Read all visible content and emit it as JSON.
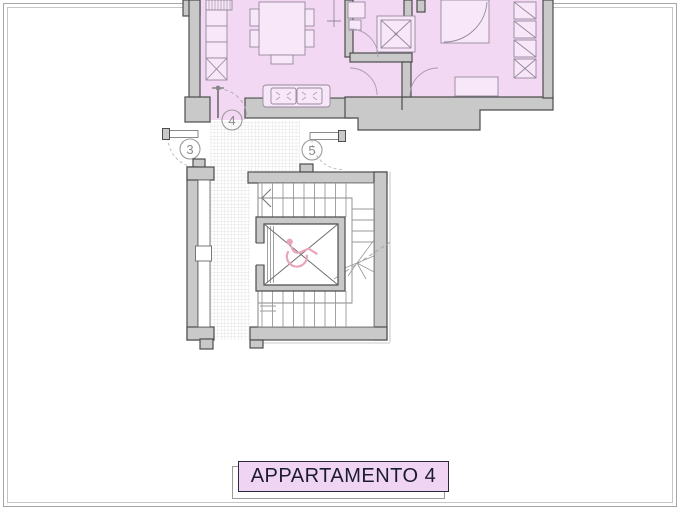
{
  "page": {
    "background": "#ffffff",
    "frame_color": "#a6a6a6"
  },
  "plan": {
    "apartment_fill": "#f2d8f2",
    "wall_fill": "#c9c9c9",
    "wall_stroke": "#4d4d4d",
    "furniture_stroke": "#95889d",
    "landing_hatch_color": "#dadada",
    "door_markers": [
      {
        "label": "3"
      },
      {
        "label": "4"
      },
      {
        "label": "5"
      }
    ],
    "elevator": {
      "icon": "wheelchair-icon",
      "icon_color": "#e9a6ba"
    }
  },
  "title_box": {
    "label": "APPARTAMENTO 4",
    "fill": "#f0d4f4",
    "border_color": "#2a2a3a",
    "text_color": "#1c1c30"
  }
}
